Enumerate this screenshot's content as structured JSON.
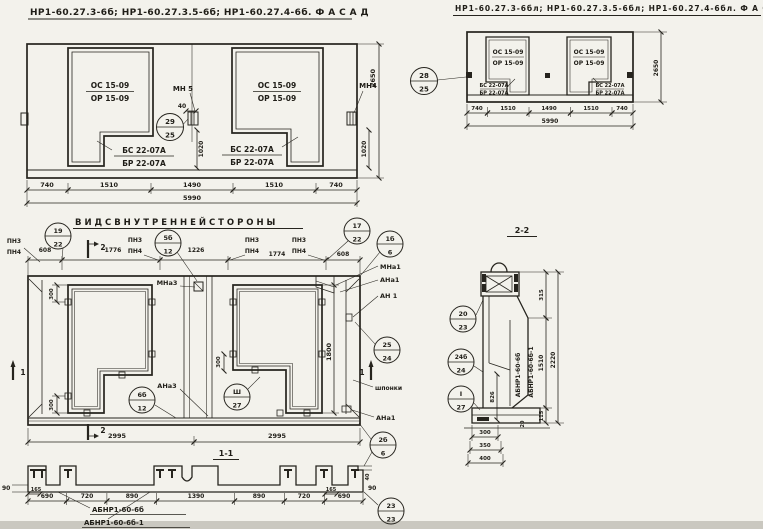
{
  "facade_left": {
    "title": "НР1-60.27.3-6б; НР1-60.27.3.5-6б; НР1-60.27.4-6б.  Ф А С А Д",
    "win_top": "ОС 15-09",
    "win_bot": "ОР 15-09",
    "sill_top": "БС 22-07А",
    "sill_bot": "БР 22-07А",
    "anchor_mid": "МН 5",
    "anchor_right": "МН4",
    "dim_40": "40",
    "callout": {
      "top": "29",
      "bot": "25"
    },
    "dim_1020": "1020",
    "dims": [
      "740",
      "1510",
      "1490",
      "1510",
      "740"
    ],
    "dim_total": "5990",
    "dim_height": "2650"
  },
  "facade_right": {
    "title": "НР1-60.27.3-6бл; НР1-60.27.3.5-6бл; НР1-60.27.4-6бл.  Ф А С А Д",
    "win_top": "ОС 15-09",
    "win_bot": "ОР 15-09",
    "sill_top": "БС 22-07А",
    "sill_bot": "БР 22-07А",
    "callout": {
      "top": "28",
      "bot": "25"
    },
    "dims": [
      "740",
      "1510",
      "1490",
      "1510",
      "740"
    ],
    "dim_total": "5990",
    "dim_height": "2650"
  },
  "inner": {
    "title": "В И Д   С   В Н У Т Р Е Н Н Е Й   С Т О Р О Н Ы",
    "dims_top": [
      "608",
      "1776",
      "1226",
      "1774",
      "608"
    ],
    "pn_top": "ПН3",
    "pn_bot": "ПН4",
    "c19": {
      "top": "19",
      "bot": "22"
    },
    "c5b": {
      "top": "5б",
      "bot": "12"
    },
    "c17": {
      "top": "17",
      "bot": "22"
    },
    "c1b": {
      "top": "1б",
      "bot": "6"
    },
    "c25": {
      "top": "25",
      "bot": "24"
    },
    "c2b": {
      "top": "2б",
      "bot": "6"
    },
    "c6b": {
      "top": "6б",
      "bot": "12"
    },
    "c3r": {
      "top": "Ш",
      "bot": "27"
    },
    "mna3": "МНа3",
    "ana3": "АНа3",
    "mna1": "МНа1",
    "ana1": "АНа1",
    "an1": "АН 1",
    "shponki": "шпонки",
    "dim_300": "300",
    "dim_1800": "1800",
    "dim_2995": "2995",
    "sec1": "1",
    "sec2": "2"
  },
  "s11": {
    "title": "1-1",
    "dims": [
      "690",
      "720",
      "890",
      "1390",
      "890",
      "720",
      "690"
    ],
    "dim_165": "165",
    "dim_90": "90",
    "dim_40": "40",
    "label1": "АБНР1-60-6б",
    "label2": "АБНР1-60-6б-1",
    "c23": {
      "top": "23",
      "bot": "23"
    }
  },
  "s22": {
    "title": "2-2",
    "dim_315": "315",
    "dim_1510": "1510",
    "dim_2220": "2220",
    "dim_826": "826",
    "dim_20": "20",
    "dim_115": "115",
    "dims_foot": [
      "300",
      "350",
      "400"
    ],
    "label1": "АБНР1-60-6б",
    "label2": "АБНР1-60-6б-1",
    "c20": {
      "top": "20",
      "bot": "23"
    },
    "c24": {
      "top": "24б",
      "bot": "24"
    },
    "c1": {
      "top": "I",
      "bot": "27"
    }
  }
}
